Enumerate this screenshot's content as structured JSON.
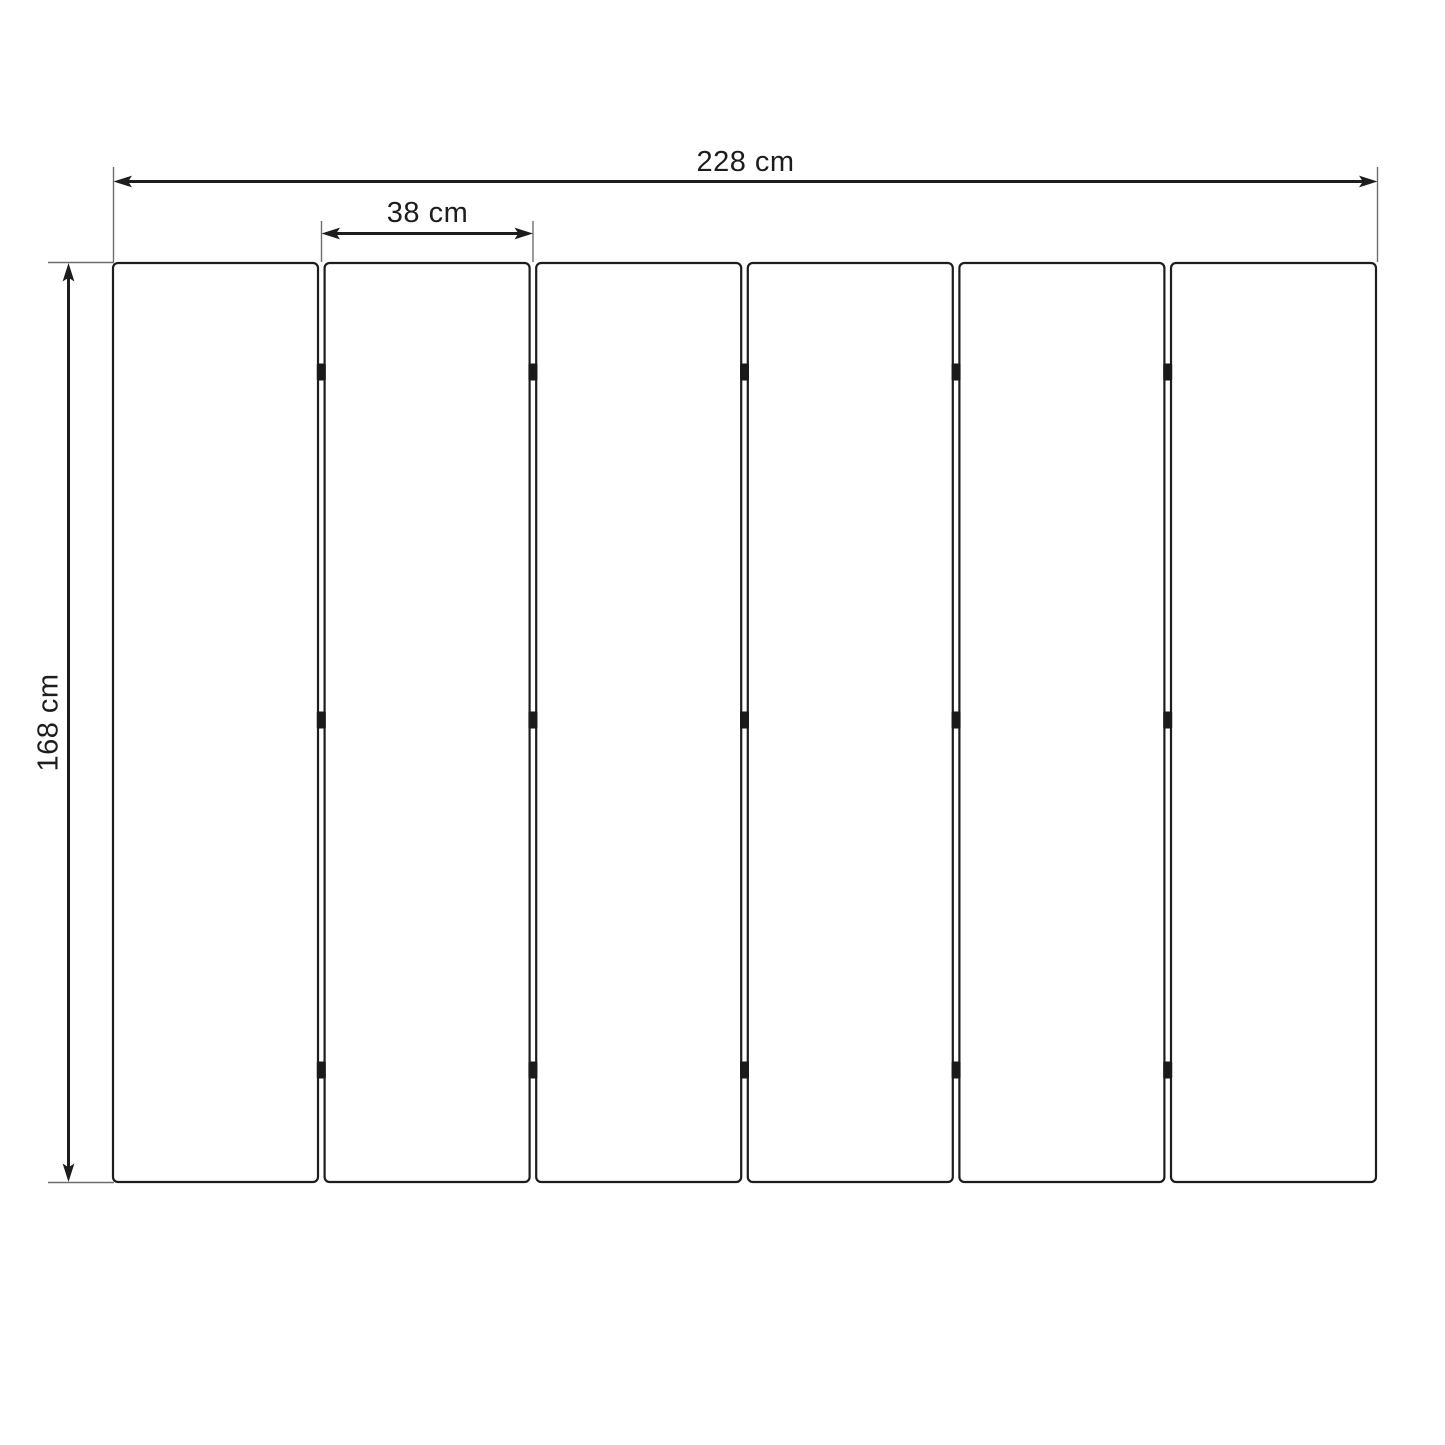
{
  "diagram": {
    "panel_count": 6,
    "hinge_rows_per_joint": 3,
    "dimensions": {
      "total_width": {
        "label": "228 cm",
        "value": 228,
        "unit": "cm"
      },
      "single_panel_width": {
        "label": "38 cm",
        "value": 38,
        "unit": "cm"
      },
      "height": {
        "label": "168 cm",
        "value": 168,
        "unit": "cm"
      }
    },
    "colors": {
      "background": "#ffffff",
      "panel_fill": "#ffffff",
      "line": "#1d1d1d",
      "extension_line": "#6e6e6e",
      "hinge": "#1a1a1a"
    }
  }
}
